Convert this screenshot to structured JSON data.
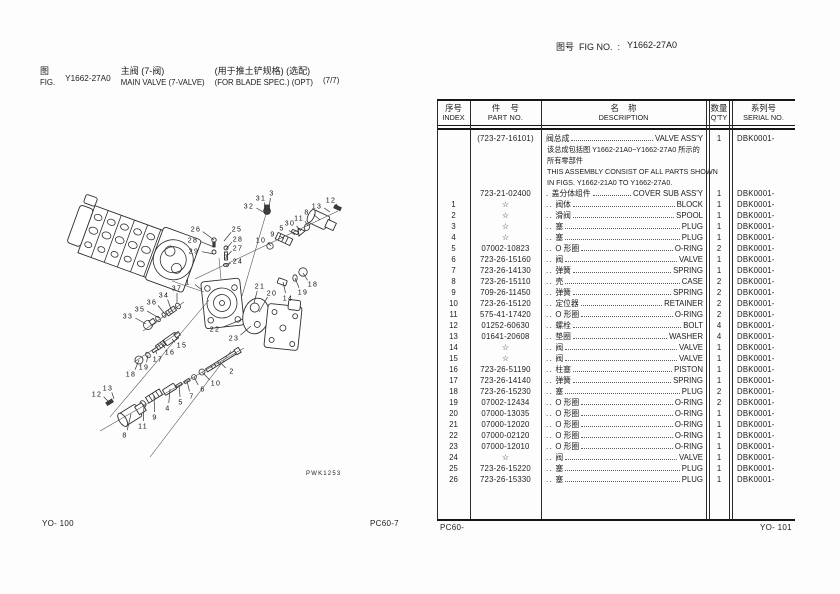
{
  "header": {
    "fig_label_cn": "图",
    "fig_label_en": "FIG.",
    "fig_no": "Y1662-27A0",
    "title_cn": "主阀 (7-阀)",
    "title_en": "MAIN VALVE (7-VALVE)",
    "spec_cn": "(用于推土铲规格) (选配)",
    "spec_en": "(FOR BLADE SPEC.) (OPT)",
    "sheet": "(7/7)",
    "figno_label": "图号  FIG NO.  :",
    "figno_value": "Y1662-27A0"
  },
  "table": {
    "headers": {
      "index_cn": "序号",
      "index_en": "INDEX",
      "part_cn": "件    号",
      "part_en": "PART NO.",
      "desc_cn": "名    称",
      "desc_en": "DESCRIPTION",
      "qty_cn": "数量",
      "qty_en": "Q'TY",
      "serial_cn": "系列号",
      "serial_en": "SERIAL NO."
    },
    "assembly_row": {
      "part_no": "(723-27-16101)",
      "desc_cn": "阀总成",
      "desc_en": "VALVE ASS'Y",
      "qty": "1",
      "serial": "DBK0001-",
      "note_lines": [
        "该总成包括图 Y1662-21A0~Y1662-27A0 所示的",
        "所有零部件",
        "THIS ASSEMBLY CONSIST OF ALL PARTS SHOWN",
        "IN FIGS. Y1662-21A0 TO Y1662-27A0."
      ]
    },
    "rows": [
      {
        "index": "",
        "part_no": "723-21-02400",
        "prefix": ".",
        "desc_cn": "盖分体组件",
        "desc_en": "COVER SUB ASS'Y",
        "qty": "1",
        "serial": "DBK0001-"
      },
      {
        "index": "1",
        "part_no": "☆",
        "prefix": "..",
        "desc_cn": "阀体",
        "desc_en": "BLOCK",
        "qty": "1",
        "serial": "DBK0001-"
      },
      {
        "index": "2",
        "part_no": "☆",
        "prefix": "..",
        "desc_cn": "滑阀",
        "desc_en": "SPOOL",
        "qty": "1",
        "serial": "DBK0001-"
      },
      {
        "index": "3",
        "part_no": "☆",
        "prefix": "..",
        "desc_cn": "塞",
        "desc_en": "PLUG",
        "qty": "1",
        "serial": "DBK0001-"
      },
      {
        "index": "4",
        "part_no": "☆",
        "prefix": "..",
        "desc_cn": "塞",
        "desc_en": "PLUG",
        "qty": "1",
        "serial": "DBK0001-"
      },
      {
        "index": "5",
        "part_no": "07002-10823",
        "prefix": "..",
        "desc_cn": "O 形圈",
        "desc_en": "O-RING",
        "qty": "2",
        "serial": "DBK0001-"
      },
      {
        "index": "6",
        "part_no": "723-26-15160",
        "prefix": "..",
        "desc_cn": "阀",
        "desc_en": "VALVE",
        "qty": "1",
        "serial": "DBK0001-"
      },
      {
        "index": "7",
        "part_no": "723-26-14130",
        "prefix": "..",
        "desc_cn": "弹簧",
        "desc_en": "SPRING",
        "qty": "1",
        "serial": "DBK0001-"
      },
      {
        "index": "8",
        "part_no": "723-26-15110",
        "prefix": "..",
        "desc_cn": "壳",
        "desc_en": "CASE",
        "qty": "2",
        "serial": "DBK0001-"
      },
      {
        "index": "9",
        "part_no": "709-26-11450",
        "prefix": "..",
        "desc_cn": "弹簧",
        "desc_en": "SPRING",
        "qty": "2",
        "serial": "DBK0001-"
      },
      {
        "index": "10",
        "part_no": "723-26-15120",
        "prefix": "..",
        "desc_cn": "定位器",
        "desc_en": "RETAINER",
        "qty": "2",
        "serial": "DBK0001-"
      },
      {
        "index": "11",
        "part_no": "575-41-17420",
        "prefix": "..",
        "desc_cn": "O 形圈",
        "desc_en": "O-RING",
        "qty": "2",
        "serial": "DBK0001-"
      },
      {
        "index": "12",
        "part_no": "01252-60630",
        "prefix": "..",
        "desc_cn": "螺栓",
        "desc_en": "BOLT",
        "qty": "4",
        "serial": "DBK0001-"
      },
      {
        "index": "13",
        "part_no": "01641-20608",
        "prefix": "..",
        "desc_cn": "垫圈",
        "desc_en": "WASHER",
        "qty": "4",
        "serial": "DBK0001-"
      },
      {
        "index": "14",
        "part_no": "☆",
        "prefix": "..",
        "desc_cn": "阀",
        "desc_en": "VALVE",
        "qty": "1",
        "serial": "DBK0001-"
      },
      {
        "index": "15",
        "part_no": "☆",
        "prefix": "..",
        "desc_cn": "阀",
        "desc_en": "VALVE",
        "qty": "1",
        "serial": "DBK0001-"
      },
      {
        "index": "16",
        "part_no": "723-26-51190",
        "prefix": "..",
        "desc_cn": "柱塞",
        "desc_en": "PISTON",
        "qty": "1",
        "serial": "DBK0001-"
      },
      {
        "index": "17",
        "part_no": "723-26-14140",
        "prefix": "..",
        "desc_cn": "弹簧",
        "desc_en": "SPRING",
        "qty": "1",
        "serial": "DBK0001-"
      },
      {
        "index": "18",
        "part_no": "723-26-15230",
        "prefix": "..",
        "desc_cn": "塞",
        "desc_en": "PLUG",
        "qty": "2",
        "serial": "DBK0001-"
      },
      {
        "index": "19",
        "part_no": "07002-12434",
        "prefix": "..",
        "desc_cn": "O 形圈",
        "desc_en": "O-RING",
        "qty": "2",
        "serial": "DBK0001-"
      },
      {
        "index": "20",
        "part_no": "07000-13035",
        "prefix": "..",
        "desc_cn": "O 形圈",
        "desc_en": "O-RING",
        "qty": "1",
        "serial": "DBK0001-"
      },
      {
        "index": "21",
        "part_no": "07000-12020",
        "prefix": "..",
        "desc_cn": "O 形圈",
        "desc_en": "O-RING",
        "qty": "1",
        "serial": "DBK0001-"
      },
      {
        "index": "22",
        "part_no": "07000-02120",
        "prefix": "..",
        "desc_cn": "O 形圈",
        "desc_en": "O-RING",
        "qty": "1",
        "serial": "DBK0001-"
      },
      {
        "index": "23",
        "part_no": "07000-12010",
        "prefix": "..",
        "desc_cn": "O 形圈",
        "desc_en": "O-RING",
        "qty": "1",
        "serial": "DBK0001-"
      },
      {
        "index": "24",
        "part_no": "☆",
        "prefix": "..",
        "desc_cn": "阀",
        "desc_en": "VALVE",
        "qty": "1",
        "serial": "DBK0001-"
      },
      {
        "index": "25",
        "part_no": "723-26-15220",
        "prefix": "..",
        "desc_cn": "塞",
        "desc_en": "PLUG",
        "qty": "1",
        "serial": "DBK0001-"
      },
      {
        "index": "26",
        "part_no": "723-26-15330",
        "prefix": "..",
        "desc_cn": "塞",
        "desc_en": "PLUG",
        "qty": "1",
        "serial": "DBK0001-"
      }
    ]
  },
  "footer": {
    "yo_left": "YO- 100",
    "pc_center": "PC60-7",
    "pc_table": "PC60-",
    "yo_right": "YO- 101"
  },
  "diagram": {
    "code": "PWK1253",
    "callouts": [
      {
        "n": "26",
        "tx": 196,
        "ty": 229,
        "px": 214,
        "py": 240
      },
      {
        "n": "25",
        "tx": 237,
        "ty": 229,
        "px": 224,
        "py": 241
      },
      {
        "n": "28",
        "tx": 193,
        "ty": 240,
        "px": 214,
        "py": 247
      },
      {
        "n": "28",
        "tx": 238,
        "ty": 239,
        "px": 226,
        "py": 249
      },
      {
        "n": "29",
        "tx": 194,
        "ty": 251,
        "px": 214,
        "py": 254
      },
      {
        "n": "27",
        "tx": 238,
        "ty": 248,
        "px": 226,
        "py": 257
      },
      {
        "n": "24",
        "tx": 238,
        "ty": 261,
        "px": 226,
        "py": 266
      },
      {
        "n": "32",
        "tx": 249,
        "ty": 206,
        "px": 263,
        "py": 212
      },
      {
        "n": "31",
        "tx": 261,
        "ty": 198,
        "px": 266,
        "py": 209
      },
      {
        "n": "3",
        "tx": 272,
        "ty": 193,
        "px": 269,
        "py": 208
      },
      {
        "n": "12",
        "tx": 331,
        "ty": 200,
        "px": 338,
        "py": 208
      },
      {
        "n": "13",
        "tx": 317,
        "ty": 206,
        "px": 330,
        "py": 212
      },
      {
        "n": "8",
        "tx": 307,
        "ty": 212,
        "px": 320,
        "py": 220
      },
      {
        "n": "11",
        "tx": 299,
        "ty": 218,
        "px": 308,
        "py": 226
      },
      {
        "n": "30",
        "tx": 290,
        "ty": 223,
        "px": 301,
        "py": 231
      },
      {
        "n": "5",
        "tx": 282,
        "ty": 228,
        "px": 295,
        "py": 235
      },
      {
        "n": "9",
        "tx": 273,
        "ty": 234,
        "px": 284,
        "py": 239
      },
      {
        "n": "10",
        "tx": 261,
        "ty": 240,
        "px": 271,
        "py": 246
      },
      {
        "n": "18",
        "tx": 313,
        "ty": 284,
        "px": 303,
        "py": 273
      },
      {
        "n": "19",
        "tx": 303,
        "ty": 292,
        "px": 295,
        "py": 278
      },
      {
        "n": "14",
        "tx": 288,
        "ty": 298,
        "px": 283,
        "py": 282
      },
      {
        "n": "1",
        "tx": 188,
        "ty": 282,
        "px": 202,
        "py": 290
      },
      {
        "n": "21",
        "tx": 260,
        "ty": 286,
        "px": 254,
        "py": 303
      },
      {
        "n": "20",
        "tx": 272,
        "ty": 293,
        "px": 259,
        "py": 312
      },
      {
        "n": "22",
        "tx": 215,
        "ty": 329,
        "px": 243,
        "py": 319
      },
      {
        "n": "23",
        "tx": 234,
        "ty": 338,
        "px": 251,
        "py": 326
      },
      {
        "n": "37",
        "tx": 177,
        "ty": 288,
        "px": 177,
        "py": 303
      },
      {
        "n": "34",
        "tx": 164,
        "ty": 295,
        "px": 171,
        "py": 309
      },
      {
        "n": "36",
        "tx": 152,
        "ty": 302,
        "px": 165,
        "py": 314
      },
      {
        "n": "35",
        "tx": 140,
        "ty": 309,
        "px": 159,
        "py": 318
      },
      {
        "n": "33",
        "tx": 128,
        "ty": 316,
        "px": 146,
        "py": 324
      },
      {
        "n": "15",
        "tx": 182,
        "ty": 345,
        "px": 172,
        "py": 339
      },
      {
        "n": "16",
        "tx": 170,
        "ty": 352,
        "px": 163,
        "py": 344
      },
      {
        "n": "17",
        "tx": 158,
        "ty": 359,
        "px": 156,
        "py": 350
      },
      {
        "n": "19",
        "tx": 144,
        "ty": 367,
        "px": 148,
        "py": 355
      },
      {
        "n": "18",
        "tx": 131,
        "ty": 374,
        "px": 139,
        "py": 360
      },
      {
        "n": "2",
        "tx": 232,
        "ty": 371,
        "px": 220,
        "py": 362
      },
      {
        "n": "10",
        "tx": 216,
        "ty": 383,
        "px": 202,
        "py": 372
      },
      {
        "n": "6",
        "tx": 203,
        "ty": 389,
        "px": 194,
        "py": 377
      },
      {
        "n": "7",
        "tx": 192,
        "ty": 396,
        "px": 187,
        "py": 381
      },
      {
        "n": "5",
        "tx": 181,
        "ty": 402,
        "px": 179,
        "py": 385
      },
      {
        "n": "4",
        "tx": 168,
        "ty": 408,
        "px": 170,
        "py": 389
      },
      {
        "n": "9",
        "tx": 155,
        "ty": 417,
        "px": 154,
        "py": 396
      },
      {
        "n": "11",
        "tx": 143,
        "ty": 426,
        "px": 144,
        "py": 404
      },
      {
        "n": "8",
        "tx": 125,
        "ty": 435,
        "px": 131,
        "py": 414
      },
      {
        "n": "13",
        "tx": 108,
        "ty": 388,
        "px": 114,
        "py": 399
      },
      {
        "n": "12",
        "tx": 97,
        "ty": 394,
        "px": 109,
        "py": 402
      }
    ]
  }
}
